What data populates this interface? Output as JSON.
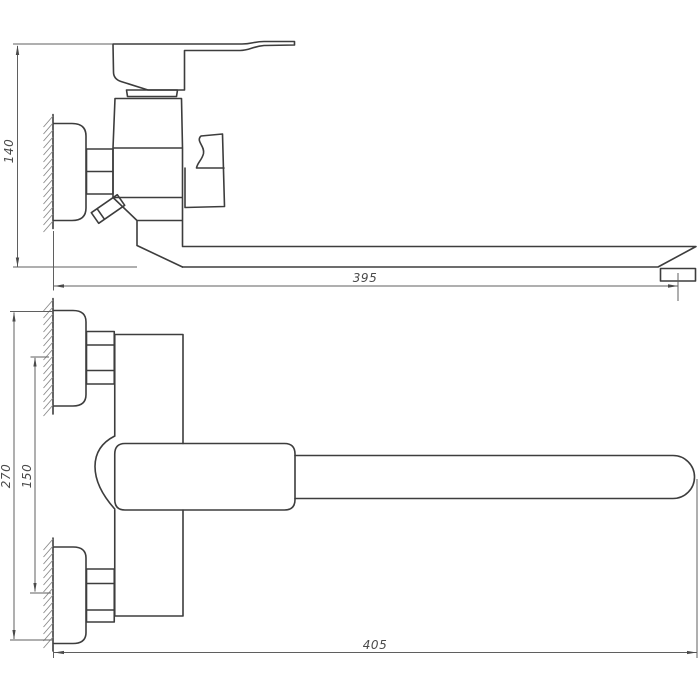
{
  "colors": {
    "background": "#ffffff",
    "object_line": "#3d3d3d",
    "dimension_line": "#5f5f5f",
    "hatch_line": "#8a8a8a",
    "label_text": "#4a4a4a"
  },
  "dimensions": {
    "top_view": {
      "height": "140",
      "reach": "395"
    },
    "bottom_view": {
      "height": "270",
      "spacing": "150",
      "reach": "405"
    }
  }
}
